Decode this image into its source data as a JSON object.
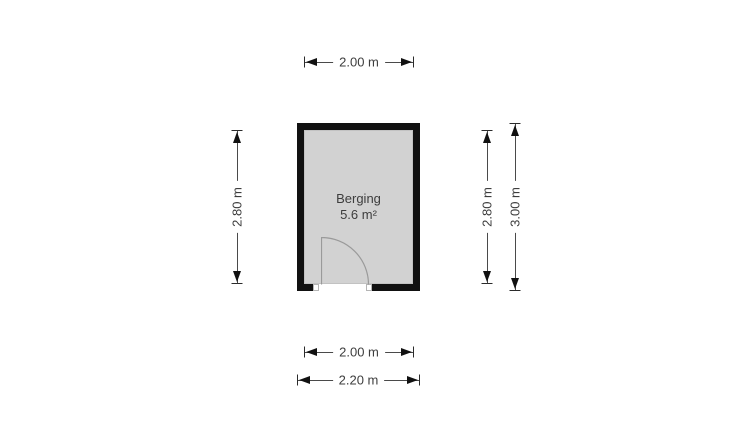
{
  "floorplan": {
    "room": {
      "name": "Berging",
      "area": "5.6 m²"
    },
    "dimensions": {
      "top_width": "2.00 m",
      "left_height": "2.80 m",
      "right_inner_height": "2.80 m",
      "right_outer_height": "3.00 m",
      "bottom_inner_width": "2.00 m",
      "bottom_outer_width": "2.20 m"
    },
    "colors": {
      "wall": "#111111",
      "floor_fill": "#d2d2d2",
      "dimension_line": "#4a4a4a",
      "arrowhead": "#111111",
      "text": "#3d3d3d",
      "door_arc": "#9a9a9a",
      "background": "#ffffff"
    }
  }
}
